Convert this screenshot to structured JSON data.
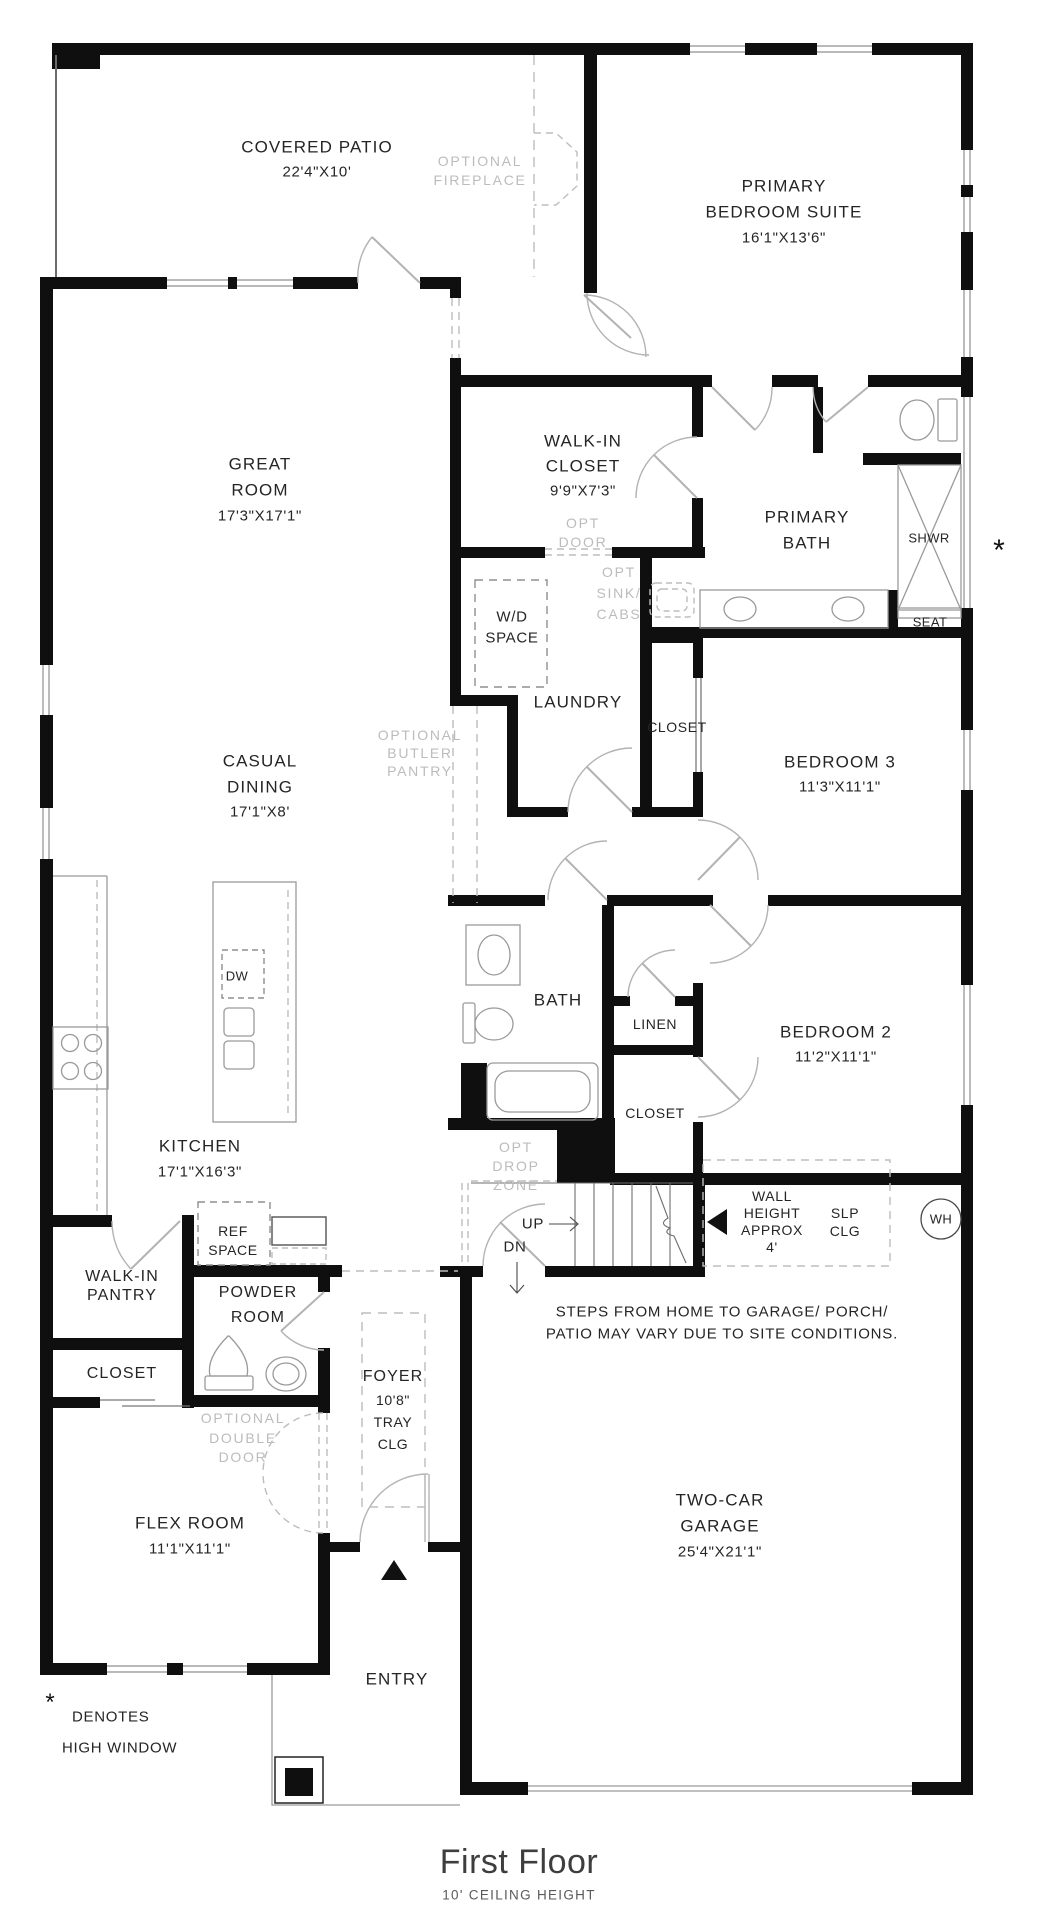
{
  "title": {
    "main": "First Floor",
    "subtitle": "10' CEILING HEIGHT"
  },
  "legend": {
    "symbol": "*",
    "line1": "DENOTES",
    "line2": "HIGH WINDOW"
  },
  "markers": {
    "high_window": "*"
  },
  "rooms": {
    "covered_patio": {
      "name": "COVERED PATIO",
      "dims": "22'4\"X10'"
    },
    "primary_suite": {
      "line1": "PRIMARY",
      "line2": "BEDROOM SUITE",
      "dims": "16'1\"X13'6\""
    },
    "great_room": {
      "line1": "GREAT",
      "line2": "ROOM",
      "dims": "17'3\"X17'1\""
    },
    "walk_in_closet": {
      "line1": "WALK-IN",
      "line2": "CLOSET",
      "dims": "9'9\"X7'3\""
    },
    "primary_bath": {
      "line1": "PRIMARY",
      "line2": "BATH"
    },
    "laundry": {
      "name": "LAUNDRY"
    },
    "closet_bed3": {
      "name": "CLOSET"
    },
    "bedroom3": {
      "name": "BEDROOM 3",
      "dims": "11'3\"X11'1\""
    },
    "casual_dining": {
      "line1": "CASUAL",
      "line2": "DINING",
      "dims": "17'1\"X8'"
    },
    "bath": {
      "name": "BATH"
    },
    "linen": {
      "name": "LINEN"
    },
    "bedroom2": {
      "name": "BEDROOM 2",
      "dims": "11'2\"X11'1\""
    },
    "closet_bed2": {
      "name": "CLOSET"
    },
    "kitchen": {
      "name": "KITCHEN",
      "dims": "17'1\"X16'3\""
    },
    "walk_in_pantry": {
      "line1": "WALK-IN",
      "line2": "PANTRY"
    },
    "powder_room": {
      "line1": "POWDER",
      "line2": "ROOM"
    },
    "closet_flex": {
      "name": "CLOSET"
    },
    "foyer": {
      "name": "FOYER",
      "dims": "10'8\"",
      "clg1": "TRAY",
      "clg2": "CLG"
    },
    "flex_room": {
      "name": "FLEX ROOM",
      "dims": "11'1\"X11'1\""
    },
    "garage": {
      "line1": "TWO-CAR",
      "line2": "GARAGE",
      "dims": "25'4\"X21'1\""
    },
    "entry": {
      "name": "ENTRY"
    }
  },
  "features": {
    "wd_space": {
      "line1": "W/D",
      "line2": "SPACE"
    },
    "shower": {
      "name": "SHWR"
    },
    "seat": {
      "name": "SEAT"
    },
    "dishwasher": {
      "name": "DW"
    },
    "ref_space": {
      "line1": "REF",
      "line2": "SPACE"
    },
    "water_heater": {
      "name": "WH"
    }
  },
  "optional": {
    "fireplace": {
      "line1": "OPTIONAL",
      "line2": "FIREPLACE"
    },
    "door": {
      "line1": "OPT",
      "line2": "DOOR"
    },
    "sink_cabs": {
      "line1": "OPT",
      "line2": "SINK/",
      "line3": "CABS"
    },
    "butler_pantry": {
      "line1": "OPTIONAL",
      "line2": "BUTLER",
      "line3": "PANTRY"
    },
    "drop_zone": {
      "line1": "OPT",
      "line2": "DROP",
      "line3": "ZONE"
    },
    "double_door": {
      "line1": "OPTIONAL",
      "line2": "DOUBLE",
      "line3": "DOOR"
    }
  },
  "stairs": {
    "up": "UP",
    "dn": "DN"
  },
  "notes": {
    "wall_height": {
      "line1": "WALL",
      "line2": "HEIGHT",
      "line3": "APPROX",
      "line4": "4'"
    },
    "slp_clg": {
      "line1": "SLP",
      "line2": "CLG"
    },
    "steps": {
      "line1": "STEPS FROM HOME TO GARAGE/ PORCH/",
      "line2": "PATIO MAY VARY DUE TO SITE CONDITIONS."
    }
  },
  "colors": {
    "wall": "#0f0f0f",
    "thin_line": "#9a9a9a",
    "optional_gray": "#bcbcbc",
    "text": "#252525"
  }
}
